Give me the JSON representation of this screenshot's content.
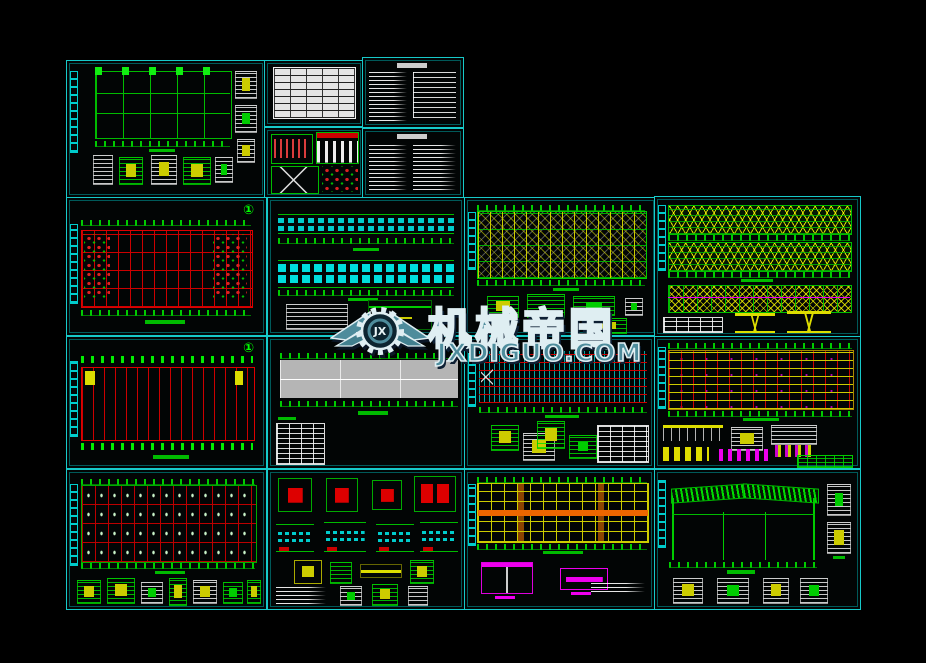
{
  "watermark": {
    "brand": "机械帝国",
    "domain": "JXDIGUO.COM",
    "monogram": "JX",
    "text_fill": "#4e8c9c",
    "outline": "#dfeef2",
    "shadow": "#0d1f33"
  },
  "marks": {
    "circle1": "①"
  },
  "colors": {
    "background": "#000000",
    "sheet_border": "#17c9c9",
    "grid_red": "#cc0000",
    "cad_green": "#00cc00",
    "cad_yellow": "#cccc00",
    "cad_cyan": "#00cccc",
    "cad_magenta": "#dd00dd",
    "orange_band": "#ee6600",
    "slab_gray": "#b5b5b5",
    "paper_white": "#e4e4e4"
  }
}
